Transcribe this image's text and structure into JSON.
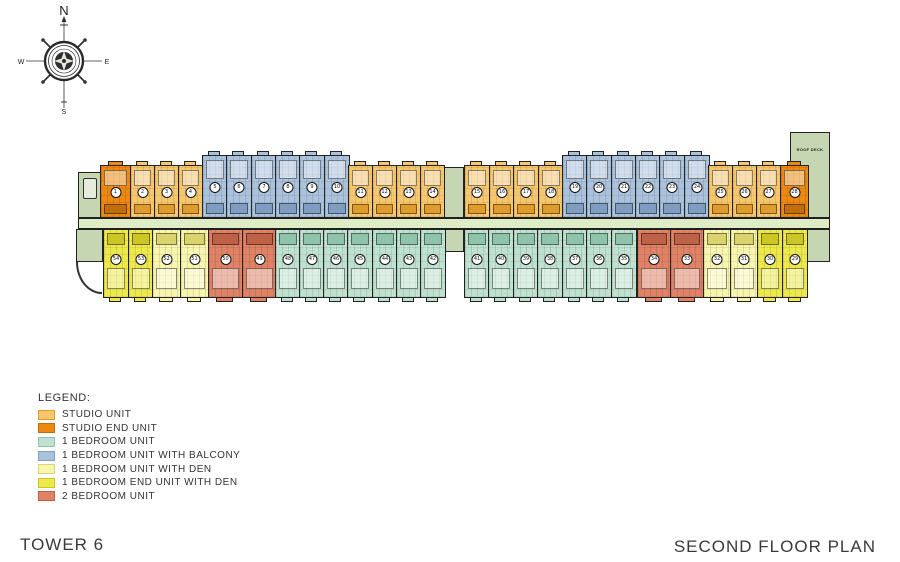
{
  "titles": {
    "tower": "TOWER 6",
    "plan": "SECOND FLOOR PLAN"
  },
  "compass": {
    "n": "N",
    "e": "E",
    "s": "S",
    "w": "W"
  },
  "legend": {
    "heading": "LEGEND:",
    "items": [
      {
        "label": "STUDIO UNIT",
        "type": "studio"
      },
      {
        "label": "STUDIO END UNIT",
        "type": "studio_end"
      },
      {
        "label": "1 BEDROOM UNIT",
        "type": "one_br"
      },
      {
        "label": "1 BEDROOM UNIT WITH BALCONY",
        "type": "one_br_balcony"
      },
      {
        "label": "1 BEDROOM UNIT WITH DEN",
        "type": "one_br_den"
      },
      {
        "label": "1 BEDROOM END UNIT WITH DEN",
        "type": "one_br_end_den"
      },
      {
        "label": "2 BEDROOM UNIT",
        "type": "two_br"
      }
    ]
  },
  "plan": {
    "colors": {
      "wall": "#1e1e1e",
      "corridor": "#dfedc6",
      "core": "#c6d6b3"
    },
    "unit_types": {
      "studio": {
        "fill": "#f6c76f",
        "accent": "#e09b2d",
        "tall": false
      },
      "studio_end": {
        "fill": "#ec8912",
        "accent": "#c26e08",
        "tall": false
      },
      "one_br": {
        "fill": "#bfe2d0",
        "accent": "#8fc4aa",
        "tall": false
      },
      "one_br_balcony": {
        "fill": "#aac2dc",
        "accent": "#7e9dc0",
        "tall": true
      },
      "one_br_den": {
        "fill": "#f8f6ae",
        "accent": "#dad36e",
        "tall": false
      },
      "one_br_end_den": {
        "fill": "#ede94b",
        "accent": "#ccc526",
        "tall": false
      },
      "two_br": {
        "fill": "#e08266",
        "accent": "#be6247",
        "tall": false
      }
    },
    "tall_extra": 10,
    "corridor": {
      "x": 78,
      "y": 218,
      "w": 752,
      "h": 11
    },
    "features": [
      {
        "name": "roof-deck",
        "kind": "deck",
        "x": 790,
        "y": 132,
        "w": 40,
        "h": 86,
        "label": "ROOF DECK"
      },
      {
        "name": "left-lobby",
        "kind": "room",
        "x": 78,
        "y": 172,
        "w": 24,
        "h": 46
      },
      {
        "name": "left-stair-core",
        "kind": "stair",
        "x": 76,
        "y": 229,
        "w": 27,
        "h": 33
      },
      {
        "name": "left-drive-arc",
        "kind": "arc",
        "x": 76,
        "y": 262,
        "w": 26,
        "h": 32
      },
      {
        "name": "center-stair-core",
        "kind": "stair",
        "x": 444,
        "y": 167,
        "w": 20,
        "h": 51
      },
      {
        "name": "center-elevator-core",
        "kind": "elevator",
        "x": 444,
        "y": 229,
        "w": 20,
        "h": 23
      },
      {
        "name": "right-stair-core",
        "kind": "stair",
        "x": 806,
        "y": 229,
        "w": 24,
        "h": 33
      }
    ],
    "rows": [
      {
        "name": "top",
        "side": "top",
        "y": 165,
        "h": 53,
        "numbering": {
          "start": 1,
          "direction": "lr"
        },
        "segments": [
          {
            "type": "studio_end",
            "x": 100,
            "w": 30,
            "count": 1
          },
          {
            "type": "studio",
            "x": 130,
            "w": 72,
            "count": 3
          },
          {
            "type": "one_br_balcony",
            "x": 202,
            "w": 146,
            "count": 6
          },
          {
            "type": "studio",
            "x": 348,
            "w": 96,
            "count": 4
          },
          {
            "type": "studio",
            "x": 464,
            "w": 98,
            "count": 4
          },
          {
            "type": "one_br_balcony",
            "x": 562,
            "w": 146,
            "count": 6
          },
          {
            "type": "studio",
            "x": 708,
            "w": 72,
            "count": 3
          },
          {
            "type": "studio_end",
            "x": 780,
            "w": 28,
            "count": 1
          }
        ]
      },
      {
        "name": "bottom",
        "side": "bottom",
        "y": 229,
        "h": 69,
        "numbering": {
          "start": 29,
          "direction": "rl"
        },
        "segments": [
          {
            "type": "one_br_end_den",
            "x": 103,
            "w": 49,
            "count": 2
          },
          {
            "type": "one_br_den",
            "x": 152,
            "w": 56,
            "count": 2
          },
          {
            "type": "two_br",
            "x": 208,
            "w": 67,
            "count": 2
          },
          {
            "type": "one_br",
            "x": 275,
            "w": 169,
            "count": 7
          },
          {
            "type": "one_br",
            "x": 464,
            "w": 171,
            "count": 7
          },
          {
            "type": "two_br",
            "x": 637,
            "w": 66,
            "count": 2
          },
          {
            "type": "one_br_den",
            "x": 703,
            "w": 54,
            "count": 2
          },
          {
            "type": "one_br_end_den",
            "x": 757,
            "w": 50,
            "count": 2
          }
        ]
      }
    ]
  }
}
